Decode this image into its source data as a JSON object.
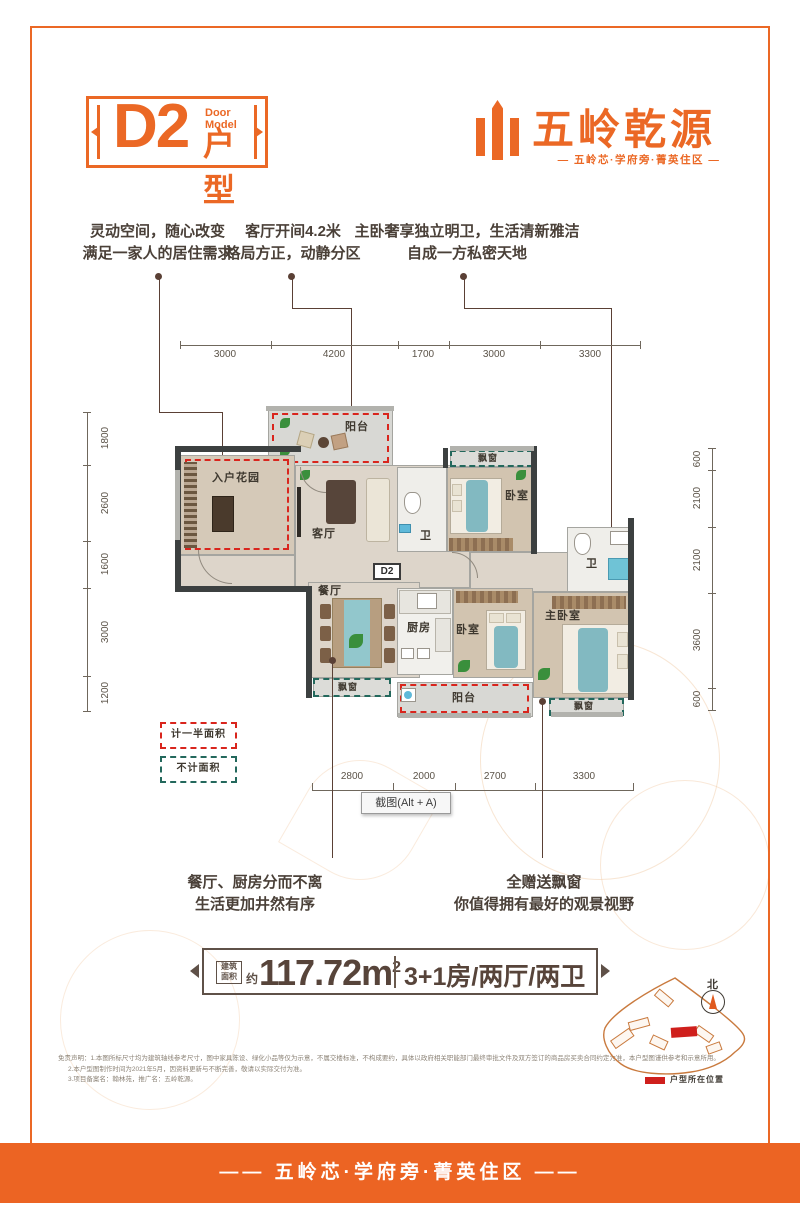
{
  "header": {
    "model_code": "D2",
    "model_label_en": "Door Model",
    "model_label_cn": "户型",
    "brand_name": "五岭乾源",
    "brand_tagline": "— 五岭芯·学府旁·菁英住区 —"
  },
  "callouts": {
    "top": [
      {
        "line1": "灵动空间，随心改变",
        "line2": "满足一家人的居住需求"
      },
      {
        "line1": "客厅开间4.2米",
        "line2": "格局方正，动静分区"
      },
      {
        "line1": "主卧奢享独立明卫，生活清新雅洁",
        "line2": "自成一方私密天地"
      }
    ],
    "bottom": [
      {
        "line1": "餐厅、厨房分而不离",
        "line2": "生活更加井然有序"
      },
      {
        "line1": "全赠送飘窗",
        "line2": "你值得拥有最好的观景视野"
      }
    ]
  },
  "dimensions": {
    "top": [
      "3000",
      "4200",
      "1700",
      "3000",
      "3300"
    ],
    "left": [
      "1800",
      "2600",
      "1600",
      "3000",
      "1200"
    ],
    "right": [
      "600",
      "2100",
      "2100",
      "3600",
      "600"
    ],
    "bottom": [
      "2800",
      "2000",
      "2700",
      "3300"
    ]
  },
  "plan": {
    "unit_label": "D2",
    "rooms": {
      "entry_garden": "入户花园",
      "balcony": "阳台",
      "living": "客厅",
      "dining": "餐厅",
      "kitchen": "厨房",
      "bedroom": "卧室",
      "master_bedroom": "主卧室",
      "bath": "卫",
      "bay_window": "飘窗"
    }
  },
  "legend": [
    {
      "label": "计一半面积",
      "color": "#d9251d"
    },
    {
      "label": "不计面积",
      "color": "#23685c"
    }
  ],
  "tooltip": {
    "label": "截图(Alt + A)"
  },
  "summary": {
    "area_label_line1": "建筑",
    "area_label_line2": "面积",
    "approx": "约",
    "area_value": "117.72m",
    "area_sup": "2",
    "layout": "3+1房/两厅/两卫"
  },
  "site_map": {
    "compass": "北",
    "legend": "户型所在位置"
  },
  "disclaimer": [
    "免责声明：1.本图所标尺寸均为建筑轴线参考尺寸，图中家具陈设、绿化小品等仅为示意，不属交楼标准，不构成要约，具体以政府相关职能部门最终审批文件及双方签订的商品房买卖合同约定为准，本户型图谨供参考和示意所用。",
    "2.本户型图制作时间为2021年5月，因资料更新与不断完善，敬请以实际交付为准。",
    "3.项目备案名：翰林苑，推广名：五岭乾源。"
  ],
  "footer": {
    "tagline": "—— 五岭芯·学府旁·菁英住区 ——"
  }
}
